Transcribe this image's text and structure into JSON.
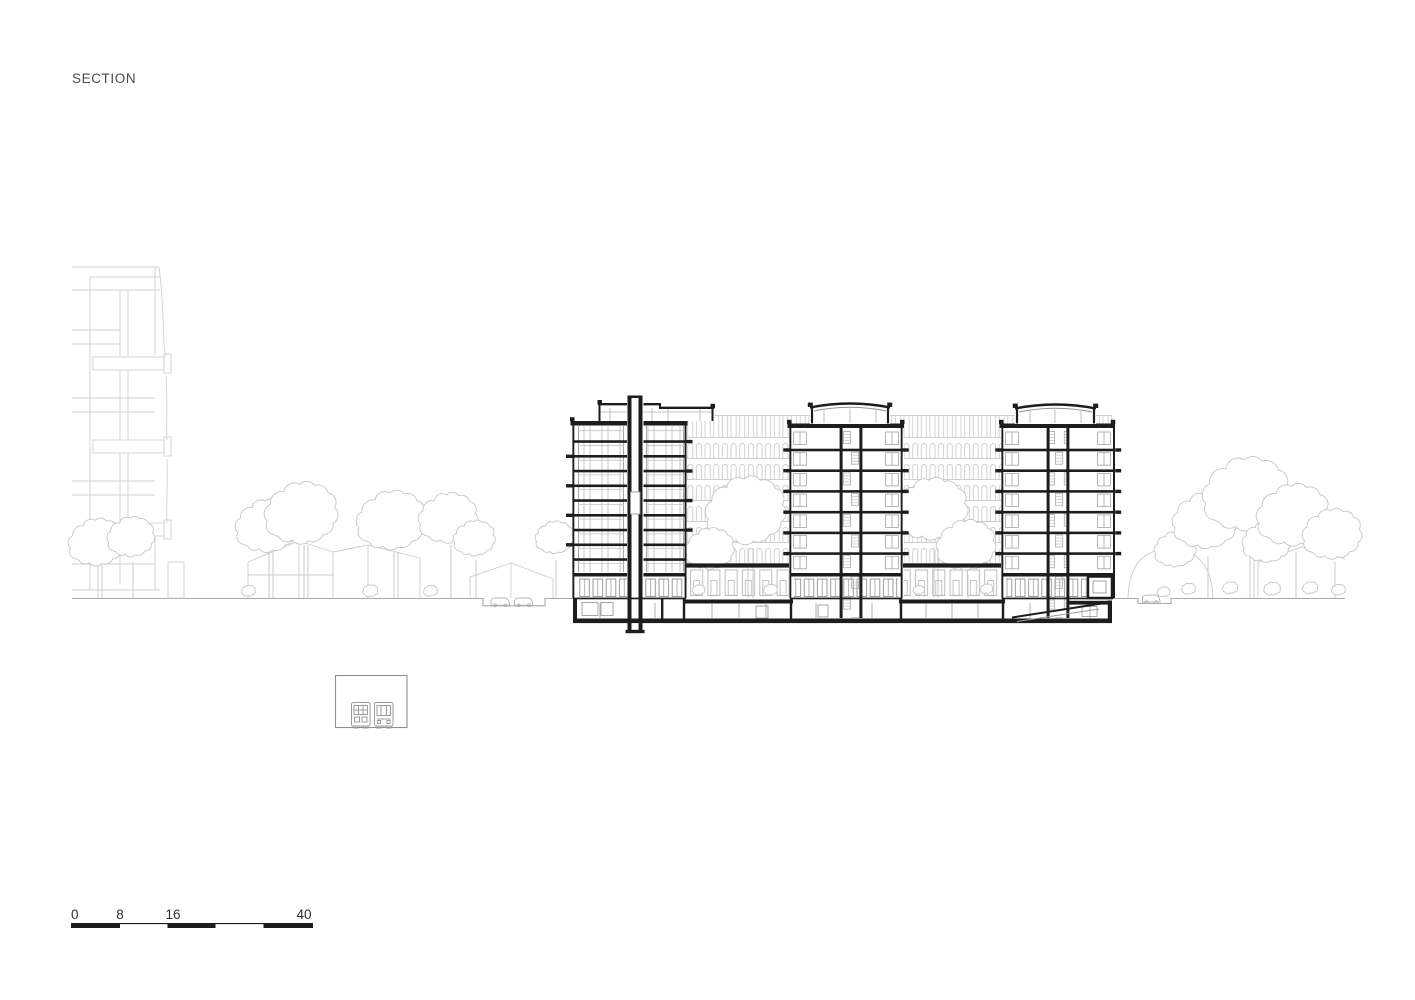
{
  "title": "SECTION",
  "scale_bar": {
    "labels": [
      "0",
      "8",
      "16",
      "40"
    ]
  }
}
